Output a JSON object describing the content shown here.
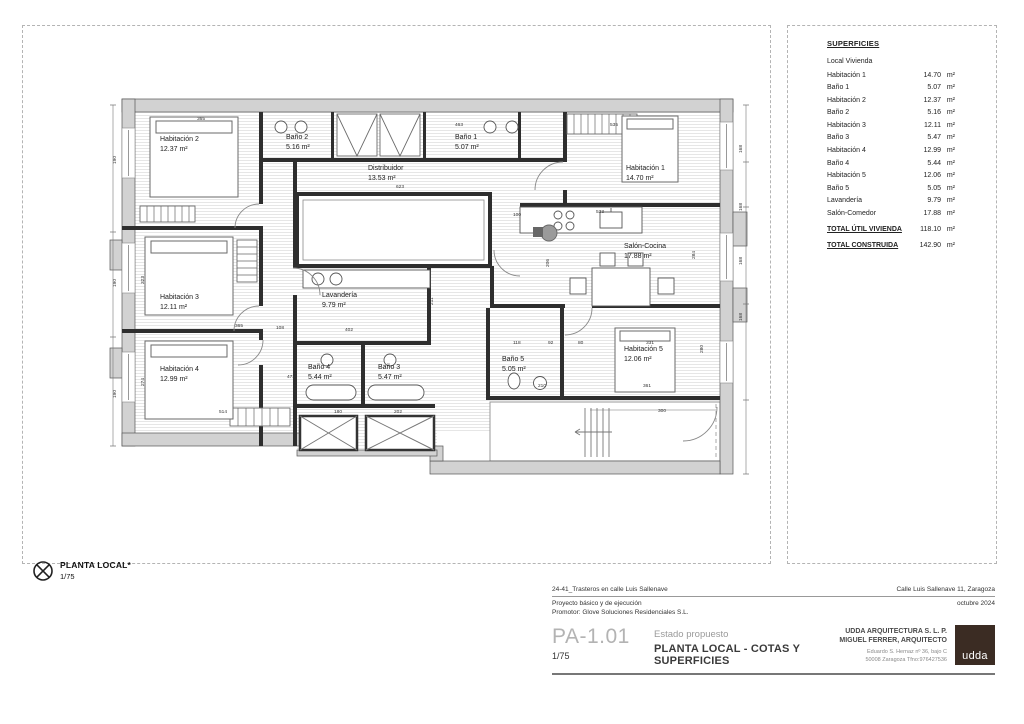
{
  "colors": {
    "logo_brown": "#3b2c23",
    "wall_dark": "#2e2e2e",
    "band_gray": "#d2d2d2"
  },
  "surfaces": {
    "title": "SUPERFICIES",
    "subtitle": "Local Vivienda",
    "unit": "m²",
    "rows": [
      {
        "label": "Habitación 1",
        "value": "14.70"
      },
      {
        "label": "Baño 1",
        "value": "5.07"
      },
      {
        "label": "Habitación 2",
        "value": "12.37"
      },
      {
        "label": "Baño 2",
        "value": "5.16"
      },
      {
        "label": "Habitación 3",
        "value": "12.11"
      },
      {
        "label": "Baño 3",
        "value": "5.47"
      },
      {
        "label": "Habitación 4",
        "value": "12.99"
      },
      {
        "label": "Baño 4",
        "value": "5.44"
      },
      {
        "label": "Habitación 5",
        "value": "12.06"
      },
      {
        "label": "Baño 5",
        "value": "5.05"
      },
      {
        "label": "Lavandería",
        "value": "9.79"
      },
      {
        "label": "Salón-Comedor",
        "value": "17.88"
      }
    ],
    "totals": [
      {
        "label": "TOTAL ÚTIL VIVIENDA",
        "value": "118.10"
      },
      {
        "label": "TOTAL CONSTRUIDA",
        "value": "142.90"
      }
    ]
  },
  "plan": {
    "rooms": [
      {
        "id": "habitacion-2",
        "name": "Habitación 2",
        "area": "12.37 m²",
        "x": 160,
        "y": 141
      },
      {
        "id": "bano-2",
        "name": "Baño 2",
        "area": "5.16 m²",
        "x": 286,
        "y": 139
      },
      {
        "id": "bano-1",
        "name": "Baño 1",
        "area": "5.07 m²",
        "x": 455,
        "y": 139
      },
      {
        "id": "habitacion-1",
        "name": "Habitación 1",
        "area": "14.70 m²",
        "x": 626,
        "y": 170
      },
      {
        "id": "distribuidor",
        "name": "Distribuidor",
        "area": "13.53 m²",
        "x": 368,
        "y": 170
      },
      {
        "id": "salon-cocina",
        "name": "Salón-Cocina",
        "area": "17.88 m²",
        "x": 624,
        "y": 248
      },
      {
        "id": "habitacion-3",
        "name": "Habitación 3",
        "area": "12.11 m²",
        "x": 160,
        "y": 299
      },
      {
        "id": "lavanderia",
        "name": "Lavandería",
        "area": "9.79 m²",
        "x": 322,
        "y": 297
      },
      {
        "id": "habitacion-4",
        "name": "Habitación 4",
        "area": "12.99 m²",
        "x": 160,
        "y": 371
      },
      {
        "id": "bano-4",
        "name": "Baño 4",
        "area": "5.44 m²",
        "x": 308,
        "y": 369
      },
      {
        "id": "bano-3",
        "name": "Baño 3",
        "area": "5.47 m²",
        "x": 378,
        "y": 369
      },
      {
        "id": "bano-5",
        "name": "Baño 5",
        "area": "5.05 m²",
        "x": 502,
        "y": 361
      },
      {
        "id": "habitacion-5",
        "name": "Habitación 5",
        "area": "12.06 m²",
        "x": 624,
        "y": 351
      }
    ],
    "dimensions": [
      {
        "t": "365",
        "x": 197,
        "y": 120
      },
      {
        "t": "463",
        "x": 455,
        "y": 126
      },
      {
        "t": "535",
        "x": 610,
        "y": 126
      },
      {
        "t": "190",
        "x": 116,
        "y": 164,
        "rot": true
      },
      {
        "t": "190",
        "x": 116,
        "y": 287,
        "rot": true
      },
      {
        "t": "190",
        "x": 116,
        "y": 398,
        "rot": true
      },
      {
        "t": "323",
        "x": 144,
        "y": 284,
        "rot": true
      },
      {
        "t": "274",
        "x": 144,
        "y": 386,
        "rot": true
      },
      {
        "t": "168",
        "x": 742,
        "y": 153,
        "rot": true
      },
      {
        "t": "168",
        "x": 742,
        "y": 211,
        "rot": true
      },
      {
        "t": "168",
        "x": 742,
        "y": 265,
        "rot": true
      },
      {
        "t": "168",
        "x": 742,
        "y": 321,
        "rot": true
      },
      {
        "t": "280",
        "x": 703,
        "y": 353,
        "rot": true
      },
      {
        "t": "284",
        "x": 695,
        "y": 259,
        "rot": true
      },
      {
        "t": "623",
        "x": 396,
        "y": 188
      },
      {
        "t": "533",
        "x": 596,
        "y": 213
      },
      {
        "t": "100",
        "x": 513,
        "y": 216
      },
      {
        "t": "206",
        "x": 549,
        "y": 267,
        "rot": true
      },
      {
        "t": "211",
        "x": 433,
        "y": 305,
        "rot": true
      },
      {
        "t": "402",
        "x": 345,
        "y": 331
      },
      {
        "t": "365",
        "x": 235,
        "y": 327
      },
      {
        "t": "108",
        "x": 276,
        "y": 329
      },
      {
        "t": "473",
        "x": 287,
        "y": 378
      },
      {
        "t": "514",
        "x": 219,
        "y": 413
      },
      {
        "t": "180",
        "x": 334,
        "y": 413
      },
      {
        "t": "202",
        "x": 394,
        "y": 413
      },
      {
        "t": "216",
        "x": 489,
        "y": 381,
        "rot": true
      },
      {
        "t": "118",
        "x": 513,
        "y": 344
      },
      {
        "t": "92",
        "x": 548,
        "y": 344
      },
      {
        "t": "80",
        "x": 578,
        "y": 344
      },
      {
        "t": "331",
        "x": 646,
        "y": 344
      },
      {
        "t": "210",
        "x": 538,
        "y": 387
      },
      {
        "t": "361",
        "x": 643,
        "y": 387
      },
      {
        "t": "300",
        "x": 658,
        "y": 412
      }
    ],
    "marker": {
      "label": "PLANTA LOCAL*",
      "scale": "1/75"
    }
  },
  "title_block": {
    "project": "24-41_Trasteros en calle Luis Sallenave",
    "address": "Calle Luis Sallenave 11, Zaragoza",
    "phase": "Proyecto básico y de ejecución",
    "date": "octubre 2024",
    "promoter": "Promotor:  Glove Soluciones Residenciales S.L.",
    "sheet_code": "PA-1.01",
    "sheet_scale": "1/75",
    "status": "Estado propuesto",
    "sheet_title": "PLANTA LOCAL - COTAS Y SUPERFICIES",
    "firm_line1": "UDDA ARQUITECTURA S. L. P.",
    "firm_line2": "MIGUEL FERRER, ARQUITECTO",
    "firm_addr1": "Eduardo S. Hernaz nº 36, bajo C",
    "firm_addr2": "50008 Zaragoza   Tfno:976427536",
    "logo_text": "udda"
  }
}
